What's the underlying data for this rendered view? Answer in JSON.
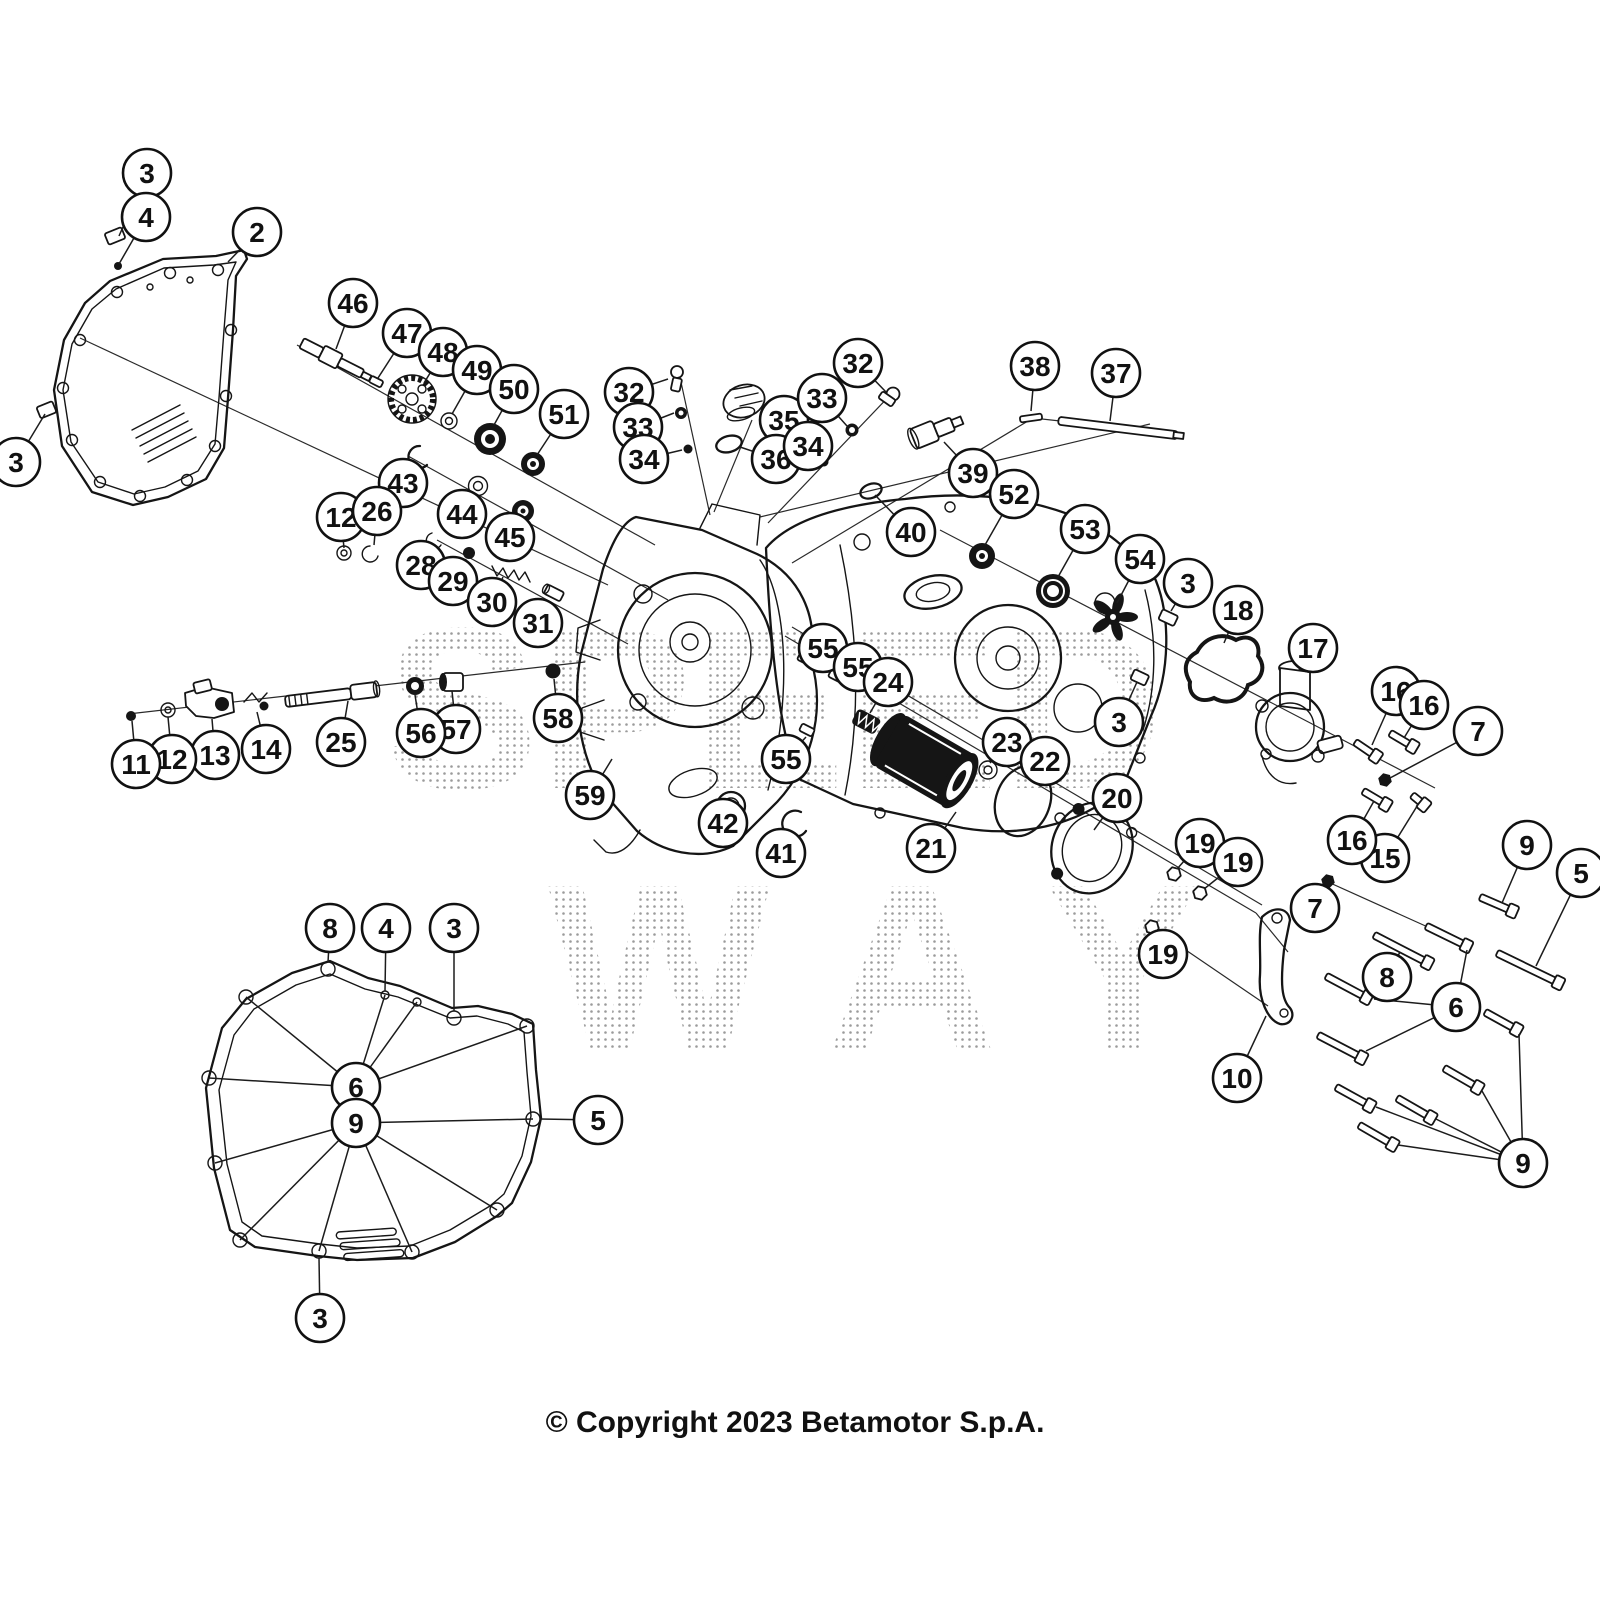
{
  "copyright": "© Copyright 2023 Betamotor S.p.A.",
  "watermark": {
    "line1": "SPEED",
    "line2": "WAY"
  },
  "callouts": [
    {
      "n": "3",
      "x": 147,
      "y": 173,
      "to": [
        [
          119,
          236
        ]
      ]
    },
    {
      "n": "4",
      "x": 146,
      "y": 217,
      "to": [
        [
          119,
          264
        ]
      ]
    },
    {
      "n": "2",
      "x": 257,
      "y": 232,
      "to": [
        [
          228,
          262
        ]
      ]
    },
    {
      "n": "3",
      "x": 16,
      "y": 462,
      "to": [
        [
          45,
          414
        ]
      ]
    },
    {
      "n": "46",
      "x": 353,
      "y": 303,
      "to": [
        [
          336,
          349
        ]
      ]
    },
    {
      "n": "47",
      "x": 407,
      "y": 333,
      "to": [
        [
          378,
          378
        ]
      ]
    },
    {
      "n": "48",
      "x": 443,
      "y": 352,
      "to": [
        [
          424,
          383
        ]
      ]
    },
    {
      "n": "49",
      "x": 477,
      "y": 370,
      "to": [
        [
          452,
          414
        ]
      ]
    },
    {
      "n": "50",
      "x": 514,
      "y": 389,
      "to": [
        [
          494,
          425
        ]
      ]
    },
    {
      "n": "51",
      "x": 564,
      "y": 414,
      "to": [
        [
          537,
          455
        ]
      ]
    },
    {
      "n": "43",
      "x": 403,
      "y": 483,
      "to": [
        [
          414,
          463
        ]
      ]
    },
    {
      "n": "44",
      "x": 462,
      "y": 514,
      "to": [
        [
          477,
          494
        ]
      ]
    },
    {
      "n": "45",
      "x": 510,
      "y": 537,
      "to": [
        [
          521,
          520
        ]
      ]
    },
    {
      "n": "12",
      "x": 341,
      "y": 517,
      "to": [
        [
          344,
          548
        ]
      ]
    },
    {
      "n": "26",
      "x": 377,
      "y": 511,
      "to": [
        [
          374,
          545
        ]
      ]
    },
    {
      "n": "28",
      "x": 421,
      "y": 565,
      "to": [
        [
          436,
          547
        ]
      ]
    },
    {
      "n": "29",
      "x": 453,
      "y": 581,
      "to": [
        [
          466,
          559
        ]
      ]
    },
    {
      "n": "30",
      "x": 492,
      "y": 602,
      "to": [
        [
          503,
          577
        ]
      ]
    },
    {
      "n": "31",
      "x": 538,
      "y": 623,
      "to": [
        [
          549,
          601
        ]
      ]
    },
    {
      "n": "32",
      "x": 629,
      "y": 392,
      "to": [
        [
          668,
          379
        ]
      ]
    },
    {
      "n": "33",
      "x": 638,
      "y": 427,
      "to": [
        [
          674,
          413
        ]
      ]
    },
    {
      "n": "34",
      "x": 644,
      "y": 459,
      "to": [
        [
          682,
          450
        ]
      ]
    },
    {
      "n": "35",
      "x": 784,
      "y": 420,
      "to": [
        [
          762,
          408
        ]
      ]
    },
    {
      "n": "36",
      "x": 776,
      "y": 459,
      "to": [
        [
          740,
          447
        ]
      ]
    },
    {
      "n": "32",
      "x": 858,
      "y": 363,
      "to": [
        [
          886,
          392
        ]
      ]
    },
    {
      "n": "33",
      "x": 822,
      "y": 398,
      "to": [
        [
          847,
          426
        ]
      ]
    },
    {
      "n": "34",
      "x": 808,
      "y": 446,
      "to": [
        [
          821,
          459
        ]
      ]
    },
    {
      "n": "38",
      "x": 1035,
      "y": 366,
      "to": [
        [
          1031,
          411
        ]
      ]
    },
    {
      "n": "37",
      "x": 1116,
      "y": 373,
      "to": [
        [
          1110,
          421
        ]
      ]
    },
    {
      "n": "39",
      "x": 973,
      "y": 473,
      "to": [
        [
          944,
          442
        ]
      ]
    },
    {
      "n": "40",
      "x": 911,
      "y": 532,
      "to": [
        [
          875,
          495
        ]
      ]
    },
    {
      "n": "52",
      "x": 1014,
      "y": 494,
      "to": [
        [
          985,
          545
        ]
      ]
    },
    {
      "n": "53",
      "x": 1085,
      "y": 529,
      "to": [
        [
          1058,
          577
        ]
      ]
    },
    {
      "n": "54",
      "x": 1140,
      "y": 559,
      "to": [
        [
          1117,
          603
        ]
      ]
    },
    {
      "n": "3",
      "x": 1188,
      "y": 583,
      "to": [
        [
          1171,
          611
        ]
      ]
    },
    {
      "n": "18",
      "x": 1238,
      "y": 610,
      "to": [
        [
          1224,
          643
        ]
      ]
    },
    {
      "n": "17",
      "x": 1313,
      "y": 648,
      "to": [
        [
          1299,
          670
        ]
      ]
    },
    {
      "n": "16",
      "x": 1396,
      "y": 691,
      "to": [
        [
          1372,
          745
        ]
      ]
    },
    {
      "n": "16",
      "x": 1424,
      "y": 705,
      "to": [
        [
          1404,
          738
        ]
      ]
    },
    {
      "n": "7",
      "x": 1478,
      "y": 731,
      "to": [
        [
          1390,
          778
        ]
      ]
    },
    {
      "n": "3",
      "x": 1119,
      "y": 722,
      "to": [
        [
          1137,
          682
        ]
      ]
    },
    {
      "n": "55",
      "x": 823,
      "y": 648,
      "to": [
        [
          807,
          660
        ]
      ]
    },
    {
      "n": "55",
      "x": 858,
      "y": 667,
      "to": [
        [
          838,
          678
        ]
      ]
    },
    {
      "n": "24",
      "x": 888,
      "y": 682,
      "to": [
        [
          870,
          713
        ]
      ]
    },
    {
      "n": "55",
      "x": 786,
      "y": 759,
      "to": [
        [
          806,
          737
        ]
      ]
    },
    {
      "n": "23",
      "x": 1007,
      "y": 742,
      "to": [
        [
          990,
          763
        ]
      ]
    },
    {
      "n": "22",
      "x": 1045,
      "y": 761,
      "to": [
        [
          1028,
          778
        ]
      ]
    },
    {
      "n": "21",
      "x": 931,
      "y": 848,
      "to": [
        [
          956,
          812
        ]
      ]
    },
    {
      "n": "20",
      "x": 1117,
      "y": 798,
      "to": [
        [
          1094,
          830
        ]
      ]
    },
    {
      "n": "19",
      "x": 1200,
      "y": 843,
      "to": [
        [
          1177,
          869
        ]
      ]
    },
    {
      "n": "19",
      "x": 1238,
      "y": 862,
      "to": [
        [
          1204,
          889
        ]
      ]
    },
    {
      "n": "19",
      "x": 1163,
      "y": 954,
      "to": [
        [
          1154,
          933
        ]
      ]
    },
    {
      "n": "42",
      "x": 723,
      "y": 823,
      "to": [
        [
          730,
          813
        ]
      ]
    },
    {
      "n": "41",
      "x": 781,
      "y": 853,
      "to": [
        [
          790,
          836
        ]
      ]
    },
    {
      "n": "59",
      "x": 590,
      "y": 795,
      "to": [
        [
          612,
          759
        ]
      ]
    },
    {
      "n": "58",
      "x": 558,
      "y": 718,
      "to": [
        [
          554,
          679
        ]
      ]
    },
    {
      "n": "57",
      "x": 456,
      "y": 729,
      "to": [
        [
          452,
          691
        ]
      ]
    },
    {
      "n": "56",
      "x": 421,
      "y": 733,
      "to": [
        [
          415,
          695
        ]
      ]
    },
    {
      "n": "25",
      "x": 341,
      "y": 742,
      "to": [
        [
          348,
          701
        ]
      ]
    },
    {
      "n": "14",
      "x": 266,
      "y": 749,
      "to": [
        [
          257,
          712
        ]
      ]
    },
    {
      "n": "13",
      "x": 215,
      "y": 755,
      "to": [
        [
          212,
          719
        ]
      ]
    },
    {
      "n": "12",
      "x": 172,
      "y": 759,
      "to": [
        [
          168,
          717
        ]
      ]
    },
    {
      "n": "11",
      "x": 136,
      "y": 764,
      "to": [
        [
          132,
          721
        ]
      ]
    },
    {
      "n": "8",
      "x": 330,
      "y": 928,
      "to": [
        [
          328,
          962
        ]
      ]
    },
    {
      "n": "4",
      "x": 386,
      "y": 928,
      "to": [
        [
          385,
          991
        ]
      ]
    },
    {
      "n": "3",
      "x": 454,
      "y": 928,
      "to": [
        [
          454,
          1011
        ]
      ]
    },
    {
      "n": "6",
      "x": 356,
      "y": 1087,
      "to": [
        [
          246,
          997
        ],
        [
          385,
          995
        ],
        [
          417,
          1002
        ],
        [
          209,
          1078
        ],
        [
          527,
          1026
        ]
      ]
    },
    {
      "n": "9",
      "x": 356,
      "y": 1123,
      "to": [
        [
          215,
          1163
        ],
        [
          240,
          1240
        ],
        [
          319,
          1251
        ],
        [
          412,
          1252
        ],
        [
          497,
          1210
        ],
        [
          533,
          1119
        ]
      ]
    },
    {
      "n": "5",
      "x": 598,
      "y": 1120,
      "to": [
        [
          540,
          1119
        ]
      ]
    },
    {
      "n": "3",
      "x": 320,
      "y": 1318,
      "to": [
        [
          319,
          1258
        ]
      ]
    },
    {
      "n": "7",
      "x": 1315,
      "y": 908,
      "to": [
        [
          1326,
          888
        ]
      ]
    },
    {
      "n": "8",
      "x": 1387,
      "y": 977,
      "to": [
        [
          1400,
          952
        ]
      ]
    },
    {
      "n": "6",
      "x": 1456,
      "y": 1007,
      "to": [
        [
          1467,
          950
        ],
        [
          1374,
          999
        ],
        [
          1366,
          1051
        ]
      ]
    },
    {
      "n": "10",
      "x": 1237,
      "y": 1078,
      "to": [
        [
          1266,
          1016
        ]
      ]
    },
    {
      "n": "9",
      "x": 1523,
      "y": 1163,
      "to": [
        [
          1519,
          1034
        ],
        [
          1482,
          1091
        ],
        [
          1436,
          1119
        ],
        [
          1376,
          1107
        ],
        [
          1398,
          1145
        ]
      ]
    },
    {
      "n": "15",
      "x": 1385,
      "y": 858,
      "to": [
        [
          1419,
          803
        ]
      ]
    },
    {
      "n": "16",
      "x": 1352,
      "y": 840,
      "to": [
        [
          1374,
          801
        ]
      ]
    },
    {
      "n": "9",
      "x": 1527,
      "y": 845,
      "to": [
        [
          1502,
          903
        ]
      ]
    },
    {
      "n": "5",
      "x": 1581,
      "y": 873,
      "to": [
        [
          1536,
          966
        ]
      ]
    }
  ],
  "axes": [
    [
      80,
      338,
      608,
      585
    ],
    [
      297,
      345,
      655,
      545
    ],
    [
      408,
      456,
      668,
      600
    ],
    [
      437,
      540,
      628,
      644
    ],
    [
      679,
      373,
      710,
      515
    ],
    [
      895,
      390,
      768,
      523
    ],
    [
      752,
      420,
      714,
      512
    ],
    [
      792,
      563,
      1033,
      418,
      1178,
      434
    ],
    [
      760,
      517,
      1150,
      424
    ],
    [
      940,
      530,
      1435,
      788
    ],
    [
      785,
      636,
      1256,
      913
    ],
    [
      792,
      627,
      1262,
      905
    ],
    [
      1256,
      913,
      1288,
      952
    ],
    [
      128,
      714,
      585,
      662
    ],
    [
      1152,
      927,
      1268,
      1006
    ],
    [
      1328,
      882,
      1430,
      928
    ]
  ],
  "bolts": [
    [
      1480,
      897,
      1517,
      913
    ],
    [
      1426,
      926,
      1471,
      948
    ],
    [
      1374,
      935,
      1432,
      965
    ],
    [
      1497,
      953,
      1563,
      985
    ],
    [
      1326,
      976,
      1371,
      1000
    ],
    [
      1485,
      1012,
      1521,
      1032
    ],
    [
      1318,
      1035,
      1366,
      1060
    ],
    [
      1444,
      1068,
      1482,
      1090
    ],
    [
      1336,
      1087,
      1374,
      1108
    ],
    [
      1397,
      1098,
      1435,
      1120
    ],
    [
      1359,
      1125,
      1397,
      1147
    ],
    [
      1355,
      742,
      1380,
      759
    ],
    [
      1390,
      733,
      1417,
      749
    ],
    [
      1363,
      791,
      1390,
      807
    ],
    [
      1412,
      795,
      1428,
      808
    ]
  ],
  "nuts": [
    {
      "x": 1385,
      "y": 780,
      "dark": true
    },
    {
      "x": 1328,
      "y": 881,
      "dark": true
    },
    {
      "x": 1174,
      "y": 874,
      "dark": false
    },
    {
      "x": 1200,
      "y": 893,
      "dark": false
    },
    {
      "x": 1152,
      "y": 927,
      "dark": false
    }
  ]
}
